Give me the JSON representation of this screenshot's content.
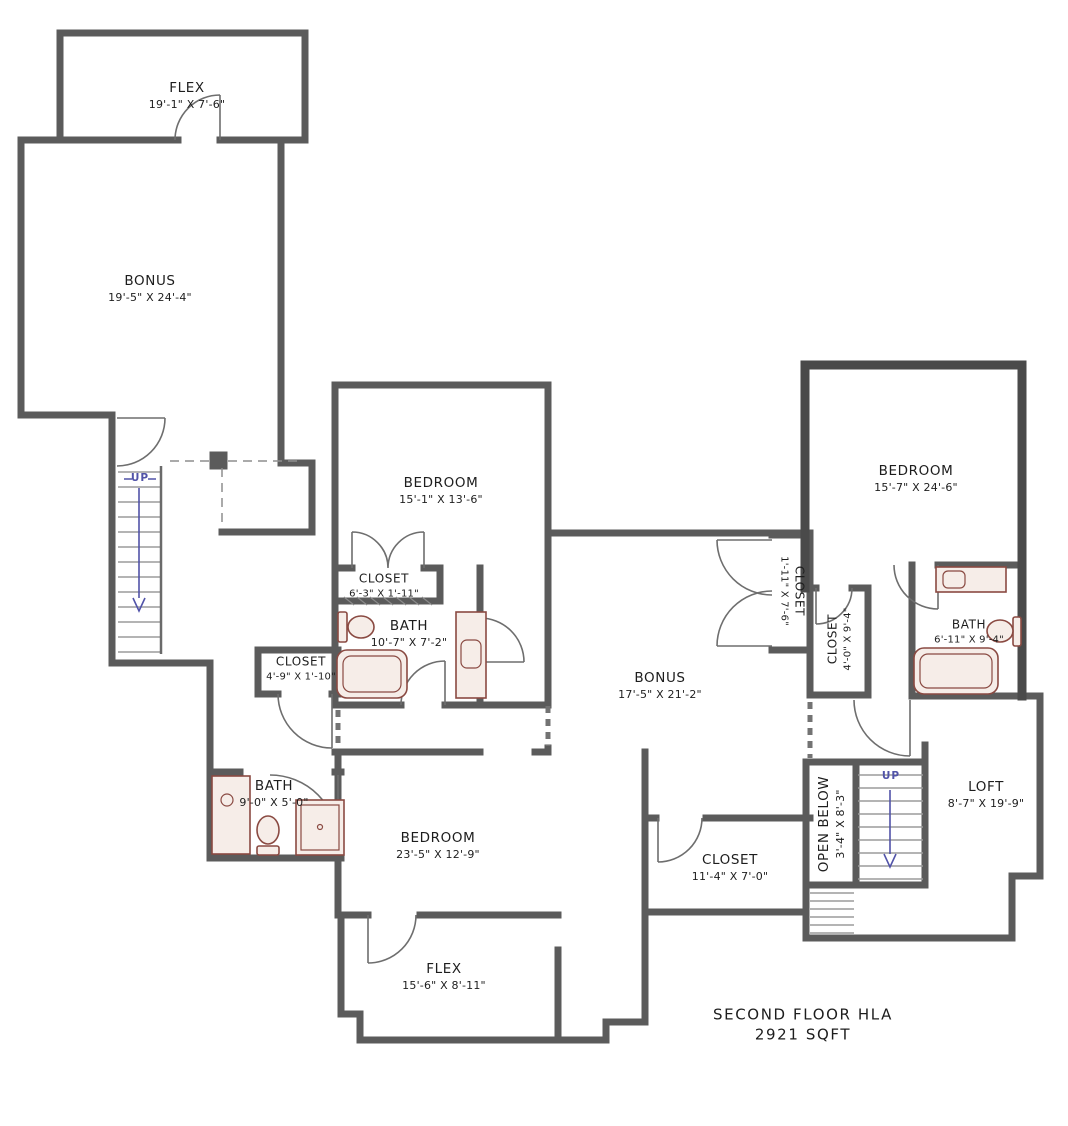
{
  "plan": {
    "title_line1": "SECOND FLOOR HLA",
    "title_line2": "2921 SQFT",
    "stairs": {
      "left_up": "UP",
      "right_up": "UP"
    },
    "rooms": {
      "flex_top": {
        "name": "FLEX",
        "dims": "19'-1\" X 7'-6\""
      },
      "bonus_left": {
        "name": "BONUS",
        "dims": "19'-5\" X 24'-4\""
      },
      "bedroom_mid": {
        "name": "BEDROOM",
        "dims": "15'-1\" X 13'-6\""
      },
      "closet_mid": {
        "name": "CLOSET",
        "dims": "6'-3\" X 1'-11\""
      },
      "bath_mid": {
        "name": "BATH",
        "dims": "10'-7\" X 7'-2\""
      },
      "closet_hall": {
        "name": "CLOSET",
        "dims": "4'-9\" X 1'-10\""
      },
      "bath_left": {
        "name": "BATH",
        "dims": "9'-0\" X 5'-0\""
      },
      "bedroom_bottom": {
        "name": "BEDROOM",
        "dims": "23'-5\" X 12'-9\""
      },
      "flex_bottom": {
        "name": "FLEX",
        "dims": "15'-6\" X 8'-11\""
      },
      "bonus_center": {
        "name": "BONUS",
        "dims": "17'-5\" X 21'-2\""
      },
      "closet_bottom": {
        "name": "CLOSET",
        "dims": "11'-4\" X 7'-0\""
      },
      "closet_tall": {
        "name": "CLOSET",
        "dims": "1'-11\" X 7'-6\""
      },
      "closet_bed2": {
        "name": "CLOSET",
        "dims": "4'-0\" X 9'-4\""
      },
      "bedroom_right": {
        "name": "BEDROOM",
        "dims": "15'-7\" X 24'-6\""
      },
      "bath_right": {
        "name": "BATH",
        "dims": "6'-11\" X 9'-4\""
      },
      "loft": {
        "name": "LOFT",
        "dims": "8'-7\" X 19'-9\""
      },
      "open_below": {
        "name": "OPEN BELOW",
        "dims": "3'-4\" X 8'-3\""
      }
    },
    "colors": {
      "wall": "#5b5b5b",
      "wall_dark": "#4a4a4a",
      "fixture": "#8a4a42",
      "fixture_fill": "#f6ede8",
      "arrow": "#5153a8"
    }
  }
}
